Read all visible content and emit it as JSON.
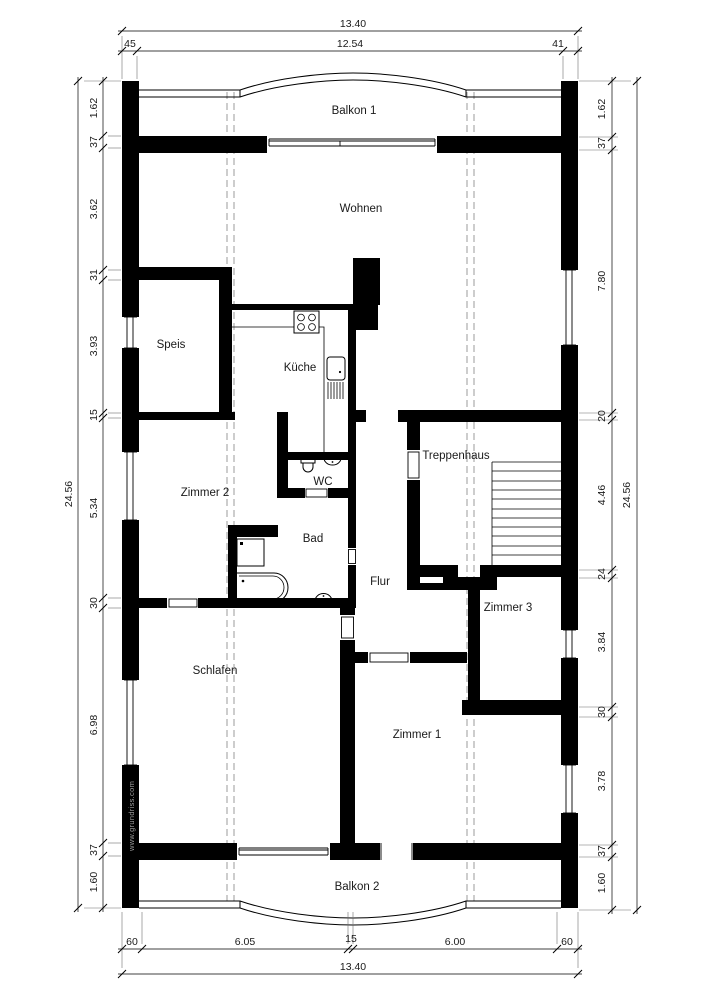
{
  "watermark": "www.grundriss.com",
  "rooms": {
    "balkon1": "Balkon 1",
    "wohnen": "Wohnen",
    "speis": "Speis",
    "kueche": "Küche",
    "zimmer2": "Zimmer 2",
    "wc": "WC",
    "bad": "Bad",
    "flur": "Flur",
    "treppenhaus": "Treppenhaus",
    "zimmer3": "Zimmer 3",
    "schlafen": "Schlafen",
    "zimmer1": "Zimmer 1",
    "balkon2": "Balkon 2"
  },
  "dimensions": {
    "top": {
      "overall": "13.40",
      "segments": [
        "45",
        "12.54",
        "41"
      ]
    },
    "bottom": {
      "overall": "13.40",
      "segments": [
        "60",
        "6.05",
        "15",
        "6.00",
        "60"
      ]
    },
    "left": {
      "overall": "24.56",
      "segments": [
        "1.62",
        "37",
        "3.62",
        "31",
        "3.93",
        "15",
        "5.34",
        "30",
        "6.98",
        "37",
        "1.60"
      ]
    },
    "right": {
      "overall": "24.56",
      "segments": [
        "1.62",
        "37",
        "7.80",
        "20",
        "4.46",
        "24",
        "3.84",
        "30",
        "3.78",
        "37",
        "1.60"
      ]
    }
  },
  "colors": {
    "wall": "#000000",
    "dashed_projection": "#9b9b9b",
    "watermark": "#9b9b9b",
    "background": "#ffffff"
  }
}
